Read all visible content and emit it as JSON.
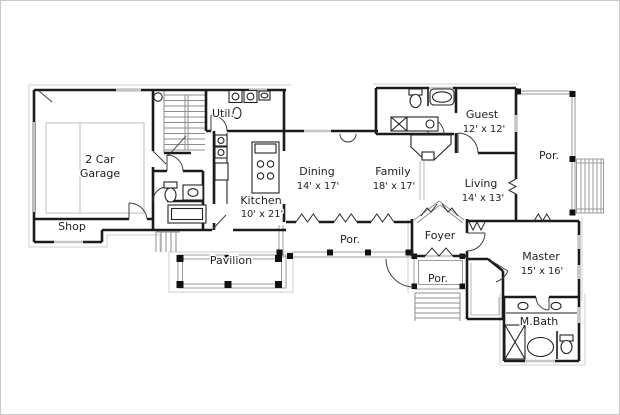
{
  "plan": {
    "type": "residential-floor-plan",
    "labels": {
      "garage_line1": "2 Car",
      "garage_line2": "Garage",
      "shop": "Shop",
      "util": "Util.",
      "kitchen": "Kitchen",
      "kitchen_dims": "10' x 21'",
      "dining": "Dining",
      "dining_dims": "14' x 17'",
      "family": "Family",
      "family_dims": "18' x 17'",
      "guest": "Guest",
      "guest_dims": "12' x 12'",
      "living": "Living",
      "living_dims": "14' x 13'",
      "porch_right": "Por.",
      "porch_center": "Por.",
      "porch_front": "Por.",
      "foyer": "Foyer",
      "pavilion": "Pavilion",
      "master": "Master",
      "master_dims": "15' x 16'",
      "mbath": "M.Bath"
    },
    "colors": {
      "wall": "#1b1b1b",
      "window_gray": "#c6c6c6",
      "thin_gray": "#9b9b9b",
      "overhang_gray": "#cfcfcf",
      "post_black": "#111111",
      "text": "#1f1f1f",
      "background": "#ffffff"
    }
  }
}
